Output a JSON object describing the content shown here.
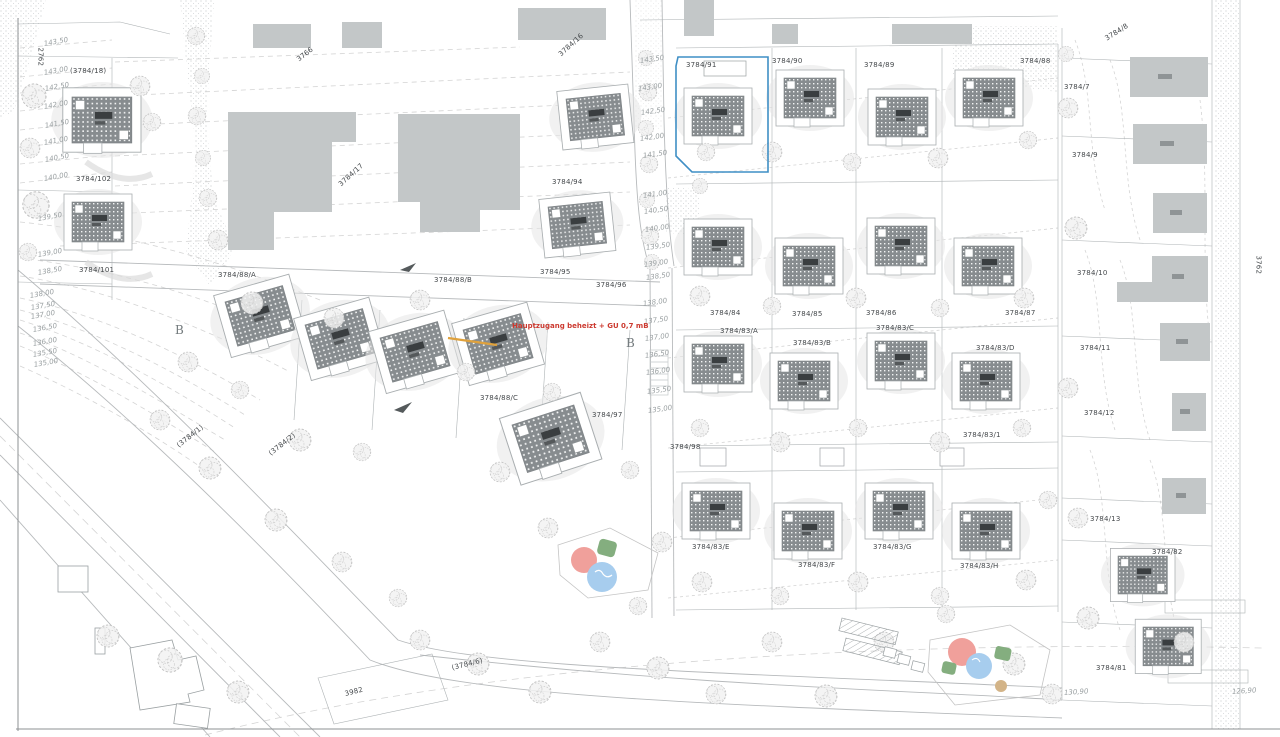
{
  "title": "Site plan with parcels 3784 – development area",
  "highlighted_parcel": "3784/91",
  "colors": {
    "highlight_parcel_outline": "#3f8fc5",
    "red_annotation": "#cc3a30",
    "orange_marker": "#dfa13c",
    "existing_building": "#c3c7c8",
    "panel_roof": "#878c8f",
    "playground_red": "#f0a09b",
    "playground_blue": "#a7cdee",
    "playground_green": "#84ae7f",
    "playground_tan": "#d3b488"
  },
  "labels": [
    {
      "text": "(3784/18)",
      "x": 70,
      "y": 68,
      "cls": "parcel"
    },
    {
      "text": "2762",
      "x": 40,
      "y": 44,
      "rot": 90,
      "cls": "parcel"
    },
    {
      "text": "3766",
      "x": 298,
      "y": 57,
      "rot": -38,
      "cls": "parcel"
    },
    {
      "text": "3784/16",
      "x": 560,
      "y": 52,
      "rot": -42,
      "cls": "parcel"
    },
    {
      "text": "3784/17",
      "x": 340,
      "y": 182,
      "rot": -42,
      "cls": "parcel"
    },
    {
      "text": "3784/102",
      "x": 76,
      "y": 176,
      "cls": "parcel"
    },
    {
      "text": "3784/101",
      "x": 79,
      "y": 267,
      "cls": "parcel"
    },
    {
      "text": "3784/88/A",
      "x": 218,
      "y": 272,
      "cls": "parcel"
    },
    {
      "text": "3784/88/B",
      "x": 434,
      "y": 277,
      "cls": "parcel"
    },
    {
      "text": "3784/88/C",
      "x": 480,
      "y": 395,
      "cls": "parcel"
    },
    {
      "text": "3784/94",
      "x": 552,
      "y": 179,
      "cls": "parcel"
    },
    {
      "text": "3784/95",
      "x": 540,
      "y": 269,
      "cls": "parcel"
    },
    {
      "text": "3784/96",
      "x": 596,
      "y": 282,
      "cls": "parcel"
    },
    {
      "text": "3784/97",
      "x": 592,
      "y": 412,
      "cls": "parcel"
    },
    {
      "text": "3784/98",
      "x": 670,
      "y": 444,
      "cls": "parcel"
    },
    {
      "text": "3784/91",
      "x": 686,
      "y": 62,
      "cls": "parcel"
    },
    {
      "text": "3784/90",
      "x": 772,
      "y": 58,
      "cls": "parcel"
    },
    {
      "text": "3784/89",
      "x": 864,
      "y": 62,
      "cls": "parcel"
    },
    {
      "text": "3784/88",
      "x": 1020,
      "y": 58,
      "cls": "parcel"
    },
    {
      "text": "3784/84",
      "x": 710,
      "y": 310,
      "cls": "parcel"
    },
    {
      "text": "3784/85",
      "x": 792,
      "y": 311,
      "cls": "parcel"
    },
    {
      "text": "3784/86",
      "x": 866,
      "y": 310,
      "cls": "parcel"
    },
    {
      "text": "3784/87",
      "x": 1005,
      "y": 310,
      "cls": "parcel"
    },
    {
      "text": "3784/83/A",
      "x": 720,
      "y": 328,
      "cls": "parcel"
    },
    {
      "text": "3784/83/B",
      "x": 793,
      "y": 340,
      "cls": "parcel"
    },
    {
      "text": "3784/83/C",
      "x": 876,
      "y": 325,
      "cls": "parcel"
    },
    {
      "text": "3784/83/D",
      "x": 976,
      "y": 345,
      "cls": "parcel"
    },
    {
      "text": "3784/83/1",
      "x": 963,
      "y": 432,
      "cls": "parcel"
    },
    {
      "text": "3784/83/E",
      "x": 692,
      "y": 544,
      "cls": "parcel"
    },
    {
      "text": "3784/83/F",
      "x": 798,
      "y": 562,
      "cls": "parcel"
    },
    {
      "text": "3784/83/G",
      "x": 873,
      "y": 544,
      "cls": "parcel"
    },
    {
      "text": "3784/83/H",
      "x": 960,
      "y": 563,
      "cls": "parcel"
    },
    {
      "text": "3784/8",
      "x": 1106,
      "y": 36,
      "rot": -32,
      "cls": "parcel"
    },
    {
      "text": "3784/7",
      "x": 1064,
      "y": 84,
      "cls": "parcel"
    },
    {
      "text": "3784/9",
      "x": 1072,
      "y": 152,
      "cls": "parcel"
    },
    {
      "text": "3784/10",
      "x": 1077,
      "y": 270,
      "cls": "parcel"
    },
    {
      "text": "3784/11",
      "x": 1080,
      "y": 345,
      "cls": "parcel"
    },
    {
      "text": "3784/12",
      "x": 1084,
      "y": 410,
      "cls": "parcel"
    },
    {
      "text": "3784/13",
      "x": 1090,
      "y": 516,
      "cls": "parcel"
    },
    {
      "text": "3784/82",
      "x": 1152,
      "y": 549,
      "cls": "parcel"
    },
    {
      "text": "3784/81",
      "x": 1096,
      "y": 665,
      "cls": "parcel"
    },
    {
      "text": "3762",
      "x": 1258,
      "y": 252,
      "rot": 90,
      "cls": "parcel"
    },
    {
      "text": "(3784/1)",
      "x": 178,
      "y": 443,
      "rot": -38,
      "cls": "parcel"
    },
    {
      "text": "(3784/2)",
      "x": 270,
      "y": 451,
      "rot": -38,
      "cls": "parcel"
    },
    {
      "text": "3982",
      "x": 345,
      "y": 691,
      "rot": -14,
      "cls": "parcel"
    },
    {
      "text": "(3784/6)",
      "x": 452,
      "y": 665,
      "rot": -14,
      "cls": "parcel"
    },
    {
      "text": "143,50",
      "x": 44,
      "y": 41,
      "rot": -10,
      "cls": "elev"
    },
    {
      "text": "143,00",
      "x": 44,
      "y": 70,
      "rot": -10,
      "cls": "elev"
    },
    {
      "text": "142,50",
      "x": 45,
      "y": 86,
      "rot": -10,
      "cls": "elev"
    },
    {
      "text": "142,00",
      "x": 44,
      "y": 104,
      "rot": -10,
      "cls": "elev"
    },
    {
      "text": "141,50",
      "x": 45,
      "y": 123,
      "rot": -10,
      "cls": "elev"
    },
    {
      "text": "141,00",
      "x": 44,
      "y": 140,
      "rot": -10,
      "cls": "elev"
    },
    {
      "text": "140,50",
      "x": 45,
      "y": 157,
      "rot": -10,
      "cls": "elev"
    },
    {
      "text": "140,00",
      "x": 44,
      "y": 176,
      "rot": -10,
      "cls": "elev"
    },
    {
      "text": "139,50",
      "x": 38,
      "y": 216,
      "rot": -10,
      "cls": "elev"
    },
    {
      "text": "139,00",
      "x": 38,
      "y": 252,
      "rot": -10,
      "cls": "elev"
    },
    {
      "text": "138,50",
      "x": 38,
      "y": 270,
      "rot": -10,
      "cls": "elev"
    },
    {
      "text": "138,00",
      "x": 30,
      "y": 293,
      "rot": -10,
      "cls": "elev"
    },
    {
      "text": "137,50",
      "x": 31,
      "y": 305,
      "rot": -10,
      "cls": "elev"
    },
    {
      "text": "137,00",
      "x": 31,
      "y": 314,
      "rot": -10,
      "cls": "elev"
    },
    {
      "text": "136,50",
      "x": 33,
      "y": 327,
      "rot": -10,
      "cls": "elev"
    },
    {
      "text": "136,00",
      "x": 33,
      "y": 341,
      "rot": -10,
      "cls": "elev"
    },
    {
      "text": "135,50",
      "x": 33,
      "y": 352,
      "rot": -10,
      "cls": "elev"
    },
    {
      "text": "135,00",
      "x": 34,
      "y": 362,
      "rot": -10,
      "cls": "elev"
    },
    {
      "text": "143,50",
      "x": 640,
      "y": 58,
      "rot": -8,
      "cls": "elev"
    },
    {
      "text": "143,00",
      "x": 638,
      "y": 86,
      "rot": -8,
      "cls": "elev"
    },
    {
      "text": "142,50",
      "x": 641,
      "y": 110,
      "rot": -8,
      "cls": "elev"
    },
    {
      "text": "142,00",
      "x": 640,
      "y": 136,
      "rot": -8,
      "cls": "elev"
    },
    {
      "text": "141,50",
      "x": 643,
      "y": 153,
      "rot": -8,
      "cls": "elev"
    },
    {
      "text": "141,00",
      "x": 643,
      "y": 193,
      "rot": -8,
      "cls": "elev"
    },
    {
      "text": "140,50",
      "x": 644,
      "y": 209,
      "rot": -8,
      "cls": "elev"
    },
    {
      "text": "140,00",
      "x": 645,
      "y": 227,
      "rot": -8,
      "cls": "elev"
    },
    {
      "text": "139,50",
      "x": 646,
      "y": 245,
      "rot": -8,
      "cls": "elev"
    },
    {
      "text": "139,00",
      "x": 644,
      "y": 262,
      "rot": -8,
      "cls": "elev"
    },
    {
      "text": "138,50",
      "x": 646,
      "y": 275,
      "rot": -8,
      "cls": "elev"
    },
    {
      "text": "138,00",
      "x": 643,
      "y": 301,
      "rot": -8,
      "cls": "elev"
    },
    {
      "text": "137,50",
      "x": 644,
      "y": 319,
      "rot": -8,
      "cls": "elev"
    },
    {
      "text": "137,00",
      "x": 645,
      "y": 336,
      "rot": -8,
      "cls": "elev"
    },
    {
      "text": "136,50",
      "x": 645,
      "y": 353,
      "rot": -8,
      "cls": "elev"
    },
    {
      "text": "136,00",
      "x": 646,
      "y": 370,
      "rot": -8,
      "cls": "elev"
    },
    {
      "text": "135,50",
      "x": 647,
      "y": 389,
      "rot": -8,
      "cls": "elev"
    },
    {
      "text": "135,00",
      "x": 648,
      "y": 408,
      "rot": -8,
      "cls": "elev"
    },
    {
      "text": "130,90",
      "x": 1064,
      "y": 690,
      "rot": -4,
      "cls": "elev"
    },
    {
      "text": "126,90",
      "x": 1232,
      "y": 689,
      "rot": -4,
      "cls": "elev"
    },
    {
      "text": "Hauptzugang beheizt + GU 0,7 mB",
      "x": 512,
      "y": 323,
      "cls": "red"
    },
    {
      "text": "B",
      "x": 175,
      "y": 324,
      "cls": "section"
    },
    {
      "text": "B",
      "x": 626,
      "y": 337,
      "cls": "section"
    }
  ]
}
